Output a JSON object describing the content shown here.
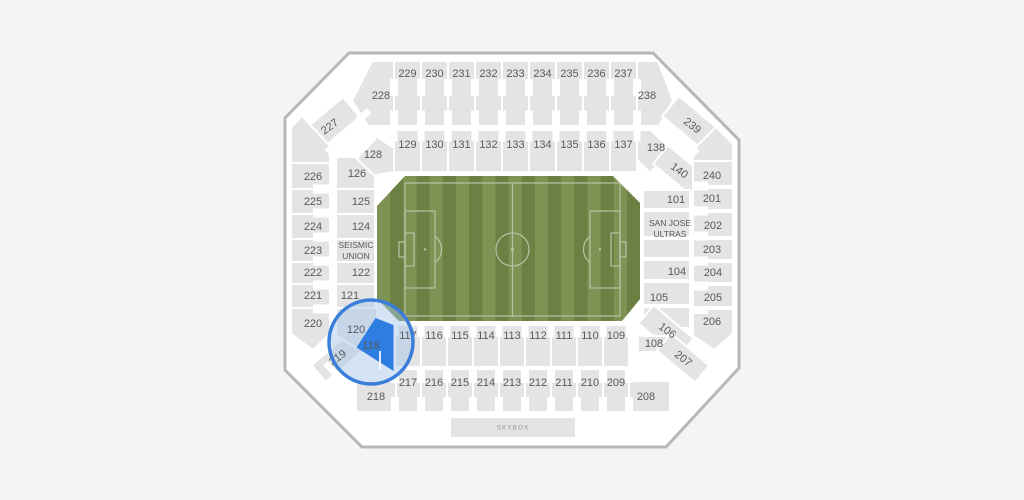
{
  "view": {
    "type": "stadium-seating-map",
    "background": "#f5f4f2"
  },
  "colors": {
    "section_fill": "#e4e4e4",
    "section_label": "#58595b",
    "stadium_wall": "#b7b7b7",
    "field_light": "#7e9254",
    "field_dark": "#6b8143",
    "pitch_line": "#b8c2a6",
    "highlight_section_fill": "#2e7de0",
    "highlight_section_label": "#4a6797",
    "highlight_circle_stroke": "#3b7ed9",
    "highlight_circle_fill": "rgba(168,198,234,0.48)",
    "skybox_label": "#979797"
  },
  "sections": {
    "101": "101",
    "104": "104",
    "105": "105",
    "106": "106",
    "108": "108",
    "109": "109",
    "110": "110",
    "111": "111",
    "112": "112",
    "113": "113",
    "114": "114",
    "115": "115",
    "116": "116",
    "117": "117",
    "118": "118",
    "120": "120",
    "121": "121",
    "122": "122",
    "124": "124",
    "125": "125",
    "126": "126",
    "128": "128",
    "129": "129",
    "130": "130",
    "131": "131",
    "132": "132",
    "133": "133",
    "134": "134",
    "135": "135",
    "136": "136",
    "137": "137",
    "138": "138",
    "140": "140",
    "201": "201",
    "202": "202",
    "203": "203",
    "204": "204",
    "205": "205",
    "206": "206",
    "207": "207",
    "208": "208",
    "209": "209",
    "210": "210",
    "211": "211",
    "212": "212",
    "213": "213",
    "214": "214",
    "215": "215",
    "216": "216",
    "217": "217",
    "218": "218",
    "219": "219",
    "220": "220",
    "221": "221",
    "222": "222",
    "223": "223",
    "224": "224",
    "225": "225",
    "226": "226",
    "227": "227",
    "228": "228",
    "229": "229",
    "230": "230",
    "231": "231",
    "232": "232",
    "233": "233",
    "234": "234",
    "235": "235",
    "236": "236",
    "237": "237",
    "238": "238",
    "239": "239",
    "240": "240"
  },
  "labels": {
    "seismic_union_line1": "SEISMIC",
    "seismic_union_line2": "UNION",
    "san_jose_ultras_line1": "SAN JOSE",
    "san_jose_ultras_line2": "ULTRAS",
    "skybox": "SKYBOX"
  },
  "highlight": {
    "selected_section": "118"
  }
}
